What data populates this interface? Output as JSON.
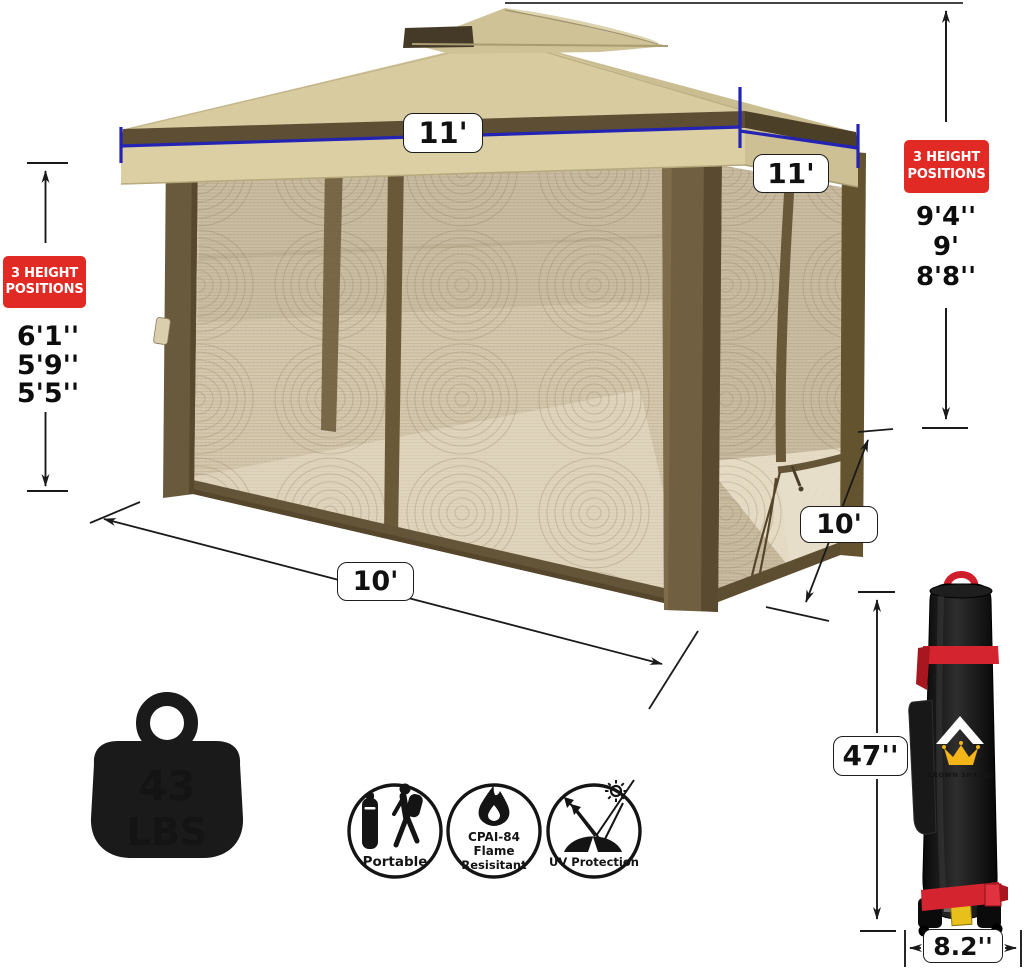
{
  "product": "pop-up gazebo with mesh netting dimension diagram",
  "canopy": {
    "top_width_label": "11'",
    "side_width_label": "11'"
  },
  "base": {
    "front_width_label": "10'",
    "side_depth_label": "10'"
  },
  "height_positions_left": {
    "badge": "3 HEIGHT POSITIONS",
    "values": [
      "6'1''",
      "5'9''",
      "5'5''"
    ]
  },
  "height_positions_right": {
    "badge": "3 HEIGHT POSITIONS",
    "values": [
      "9'4''",
      "9'",
      "8'8''"
    ]
  },
  "weight": {
    "value": "43",
    "unit": "LBS"
  },
  "features": [
    {
      "icon": "portable-hiker-icon",
      "lines": [
        "Portable"
      ]
    },
    {
      "icon": "flame-icon",
      "lines": [
        "CPAI-84",
        "Flame",
        "Resisitant"
      ]
    },
    {
      "icon": "uv-protection-icon",
      "lines": [
        "UV Protection"
      ]
    }
  ],
  "carry_bag": {
    "brand": "CROWN SHADES",
    "height_label": "47''",
    "width_label": "8.2''"
  },
  "colors": {
    "canopy_tan": "#d8cba0",
    "trim_brown": "#6a5939",
    "mesh_beige": "#d6cab2",
    "dimension_blue": "#2323b4",
    "badge_red": "#e22a25",
    "bag_black": "#141414",
    "strap_red": "#d42430",
    "crown_yellow": "#f3b517"
  }
}
